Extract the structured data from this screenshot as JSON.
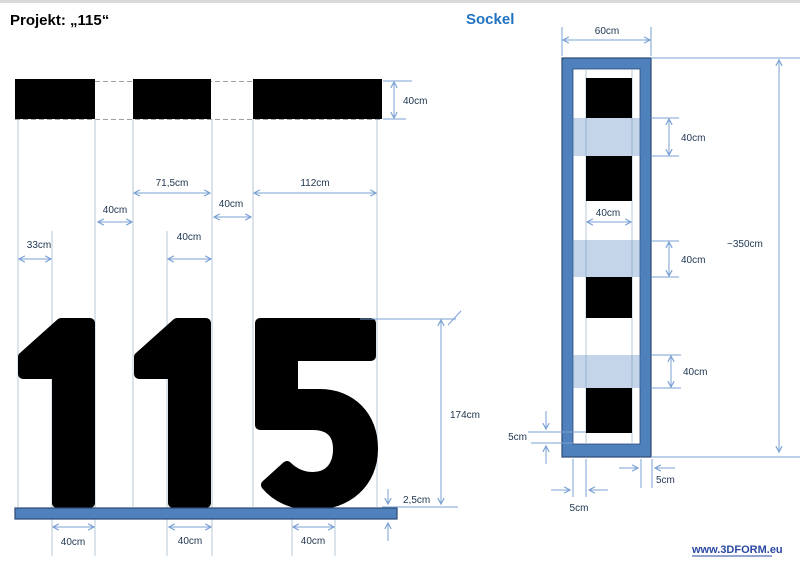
{
  "title": "Projekt: „115“",
  "front_view": {
    "dims": {
      "block_height": "40cm",
      "digit2_width": "71,5cm",
      "digit3_width": "112cm",
      "gap_1_2": "40cm",
      "gap_2_3": "40cm",
      "digit1_offset": "33cm",
      "digit2_stem": "40cm",
      "digit_height": "174cm",
      "plate_thickness": "2,5cm",
      "stem_widths": [
        "40cm",
        "40cm",
        "40cm"
      ]
    },
    "digits_text": "115"
  },
  "sockel_view": {
    "title": "Sockel",
    "dims": {
      "outer_width": "60cm",
      "band_heights": [
        "40cm",
        "40cm",
        "40cm"
      ],
      "column_width": "40cm",
      "total_height": "~350cm",
      "bottom_clearance": "5cm",
      "right_wall": "5cm",
      "left_gap": "5cm"
    }
  },
  "footer": {
    "website": "www.3DFORM.eu"
  },
  "colors": {
    "frame_blue": "#4f81bd",
    "frame_outline": "#2b4a73",
    "band_blue": "rgba(79,129,189,0.33)",
    "dim_line": "#7aa0d4",
    "label_text": "#1e3550",
    "heading_blue": "#2173c2",
    "link_blue": "#2b49a3"
  }
}
